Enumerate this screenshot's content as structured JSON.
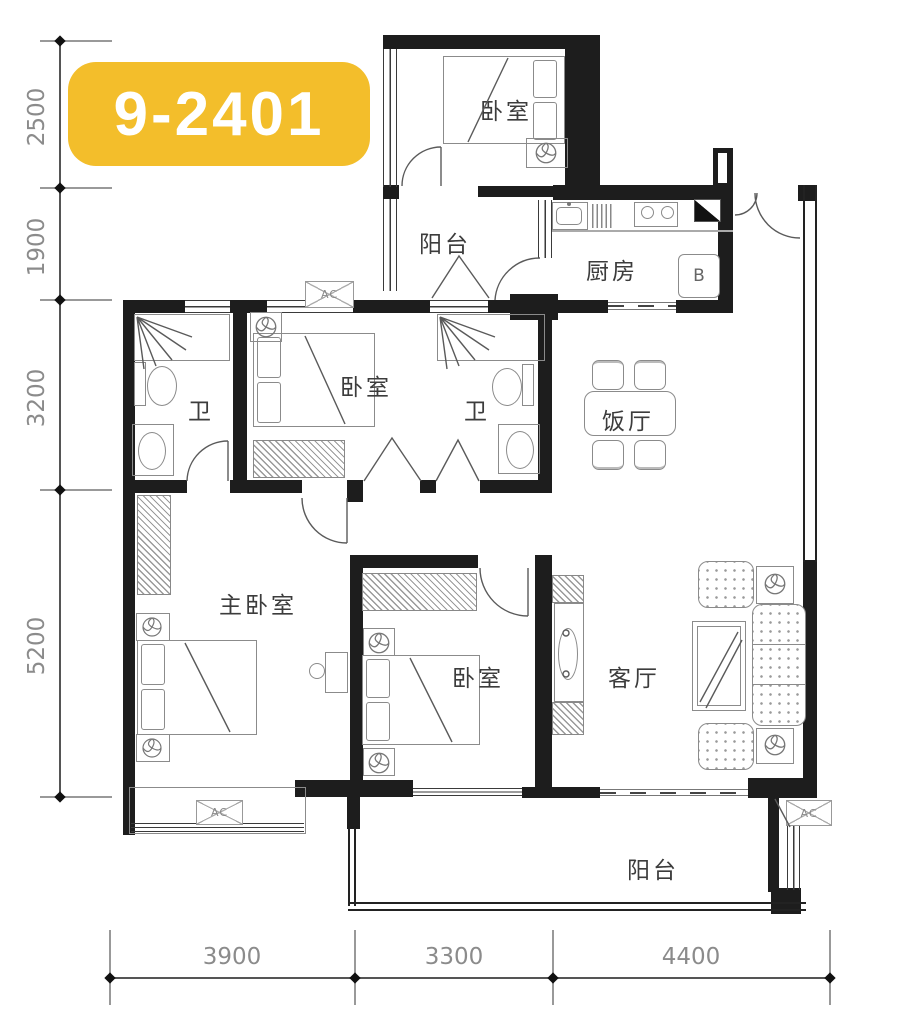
{
  "badge": {
    "unit_number": "9-2401"
  },
  "rooms": {
    "bedroom_top": "卧室",
    "balcony_top": "阳台",
    "kitchen": "厨房",
    "bath_left": "卫",
    "bedroom_middle": "卧室",
    "bath_right": "卫",
    "dining": "饭厅",
    "master_bedroom": "主卧室",
    "bedroom_bottom": "卧室",
    "living": "客厅",
    "balcony_bottom": "阳台"
  },
  "labels": {
    "ac_unit": "AC",
    "appliance_b": "B"
  },
  "dimensions": {
    "left": [
      "2500",
      "1900",
      "3200",
      "5200"
    ],
    "bottom": [
      "3900",
      "3300",
      "4400"
    ]
  },
  "colors": {
    "badge_bg": "#F3BE2B",
    "badge_text": "#FFFFFF",
    "wall": "#1D1D1D"
  }
}
